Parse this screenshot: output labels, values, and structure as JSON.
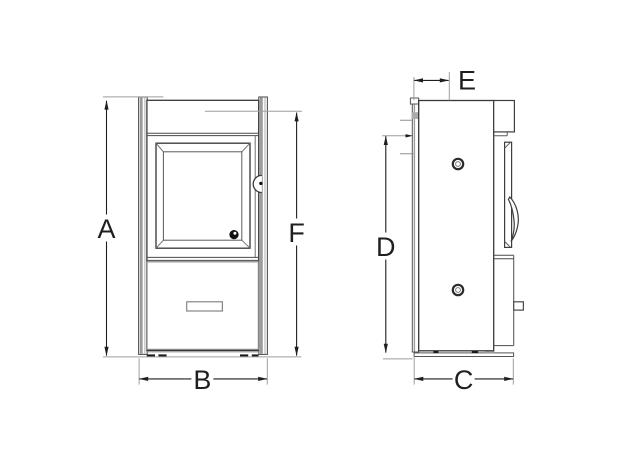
{
  "drawing": {
    "subject": "stove-dimension-diagram",
    "dim_labels": {
      "a": "A",
      "b": "B",
      "c": "C",
      "d": "D",
      "e": "E",
      "f": "F"
    }
  },
  "colors": {
    "background": "#ffffff",
    "outline_dark": "#383838",
    "outline_medium": "#707070",
    "drawer_outline": "#858585",
    "extension_gray": "#9e9e9e",
    "panel_gray": "#9c9c9c",
    "slab_gray": "#ababab",
    "dim_line": "#1f1f1f",
    "knob_black": "#111111"
  }
}
